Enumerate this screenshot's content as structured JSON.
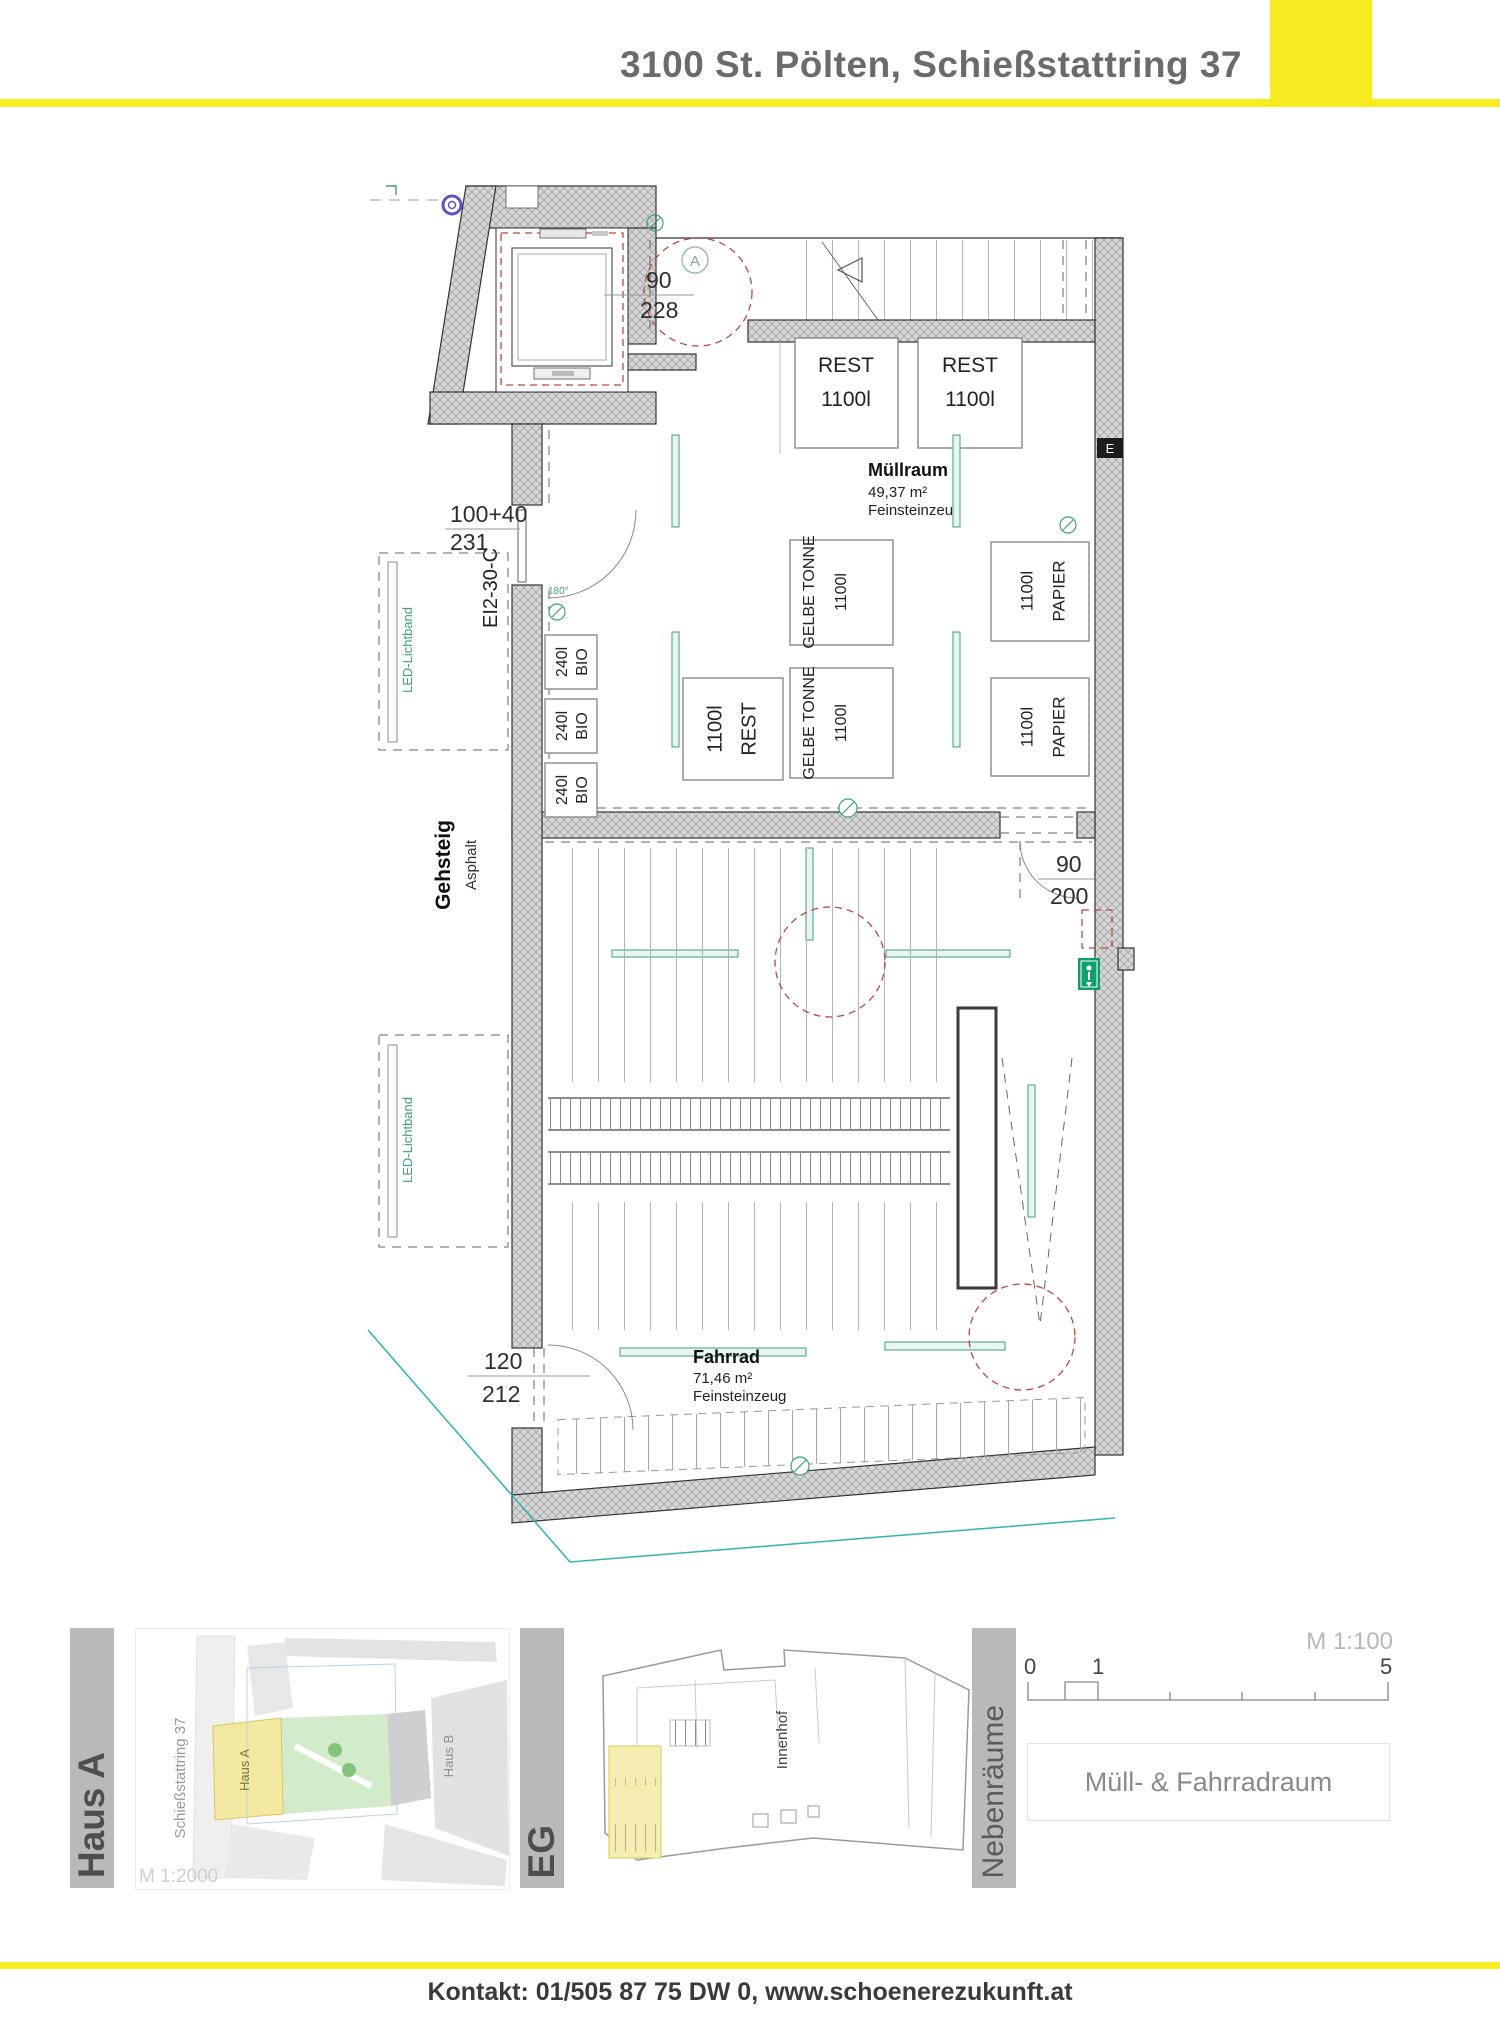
{
  "header": {
    "title": "3100 St. Pölten, Schießstattring 37"
  },
  "plan": {
    "marker_a": "A",
    "electrical": "E",
    "fire_door": "EI2-30-C",
    "swing": "180°",
    "led": "LED-Lichtband",
    "sidewalk": {
      "name": "Gehsteig",
      "material": "Asphalt"
    },
    "dims": {
      "lift_door": {
        "w": "90",
        "h": "228"
      },
      "entry_door": {
        "w": "100+40",
        "h": "231"
      },
      "inner_door": {
        "w": "90",
        "h": "200"
      },
      "bike_door": {
        "w": "120",
        "h": "212"
      }
    },
    "rooms": {
      "muell": {
        "name": "Müllraum",
        "area": "49,37 m²",
        "floor": "Feinsteinzeug"
      },
      "fahrrad": {
        "name": "Fahrrad",
        "area": "71,46 m²",
        "floor": "Feinsteinzeug"
      }
    },
    "bins": {
      "rest_top": [
        {
          "l1": "REST",
          "l2": "1100l"
        },
        {
          "l1": "REST",
          "l2": "1100l"
        }
      ],
      "bio": [
        {
          "l1": "240l",
          "l2": "BIO"
        },
        {
          "l1": "240l",
          "l2": "BIO"
        },
        {
          "l1": "240l",
          "l2": "BIO"
        }
      ],
      "rest_side": {
        "l1": "1100l",
        "l2": "REST"
      },
      "gelbe": [
        {
          "l1": "GELBE TONNE",
          "l2": "1100l"
        },
        {
          "l1": "GELBE TONNE",
          "l2": "1100l"
        }
      ],
      "papier": [
        {
          "l1": "1100l",
          "l2": "PAPIER"
        },
        {
          "l1": "1100l",
          "l2": "PAPIER"
        }
      ]
    }
  },
  "legend": {
    "building_bar": "Haus A",
    "site": {
      "street": "Schießstattring 37",
      "haus_a": "Haus A",
      "haus_b": "Haus B",
      "scale": "M 1:2000"
    },
    "level_bar": "EG",
    "keyplan": {
      "courtyard": "Innenhof"
    },
    "category_bar": "Nebenräume",
    "scalebar": {
      "label": "M 1:100",
      "t0": "0",
      "t1": "1",
      "t5": "5"
    },
    "sheet_title": "Müll- & Fahrradraum"
  },
  "footer": {
    "contact": "Kontakt: 01/505 87 75 DW 0, www.schoenerezukunft.at"
  },
  "colors": {
    "accent": "#F7EC1F",
    "wall_hatch": "#d7d7d7",
    "red_dash": "#b64a3f",
    "green": "#3f9e7e",
    "teal": "#33b3ad",
    "exit_green": "#0e9f6e"
  }
}
